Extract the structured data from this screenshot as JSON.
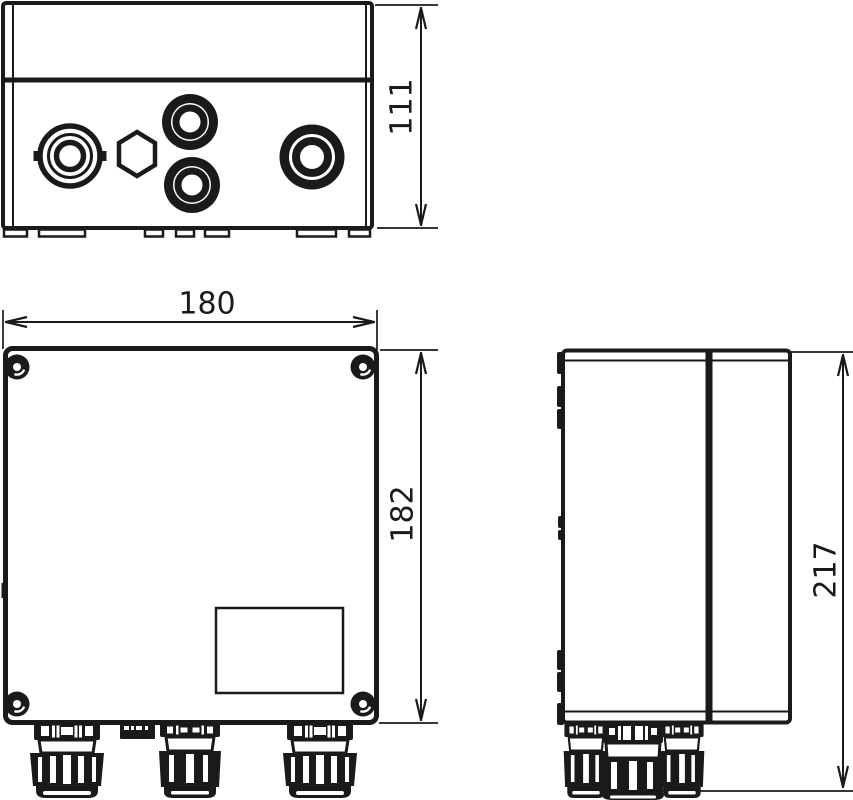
{
  "drawing": {
    "background_color": "#ffffff",
    "line_color": "#1a1a1a"
  },
  "dimensions": {
    "depth": "111",
    "width": "180",
    "height": "182",
    "total_height": "217"
  }
}
